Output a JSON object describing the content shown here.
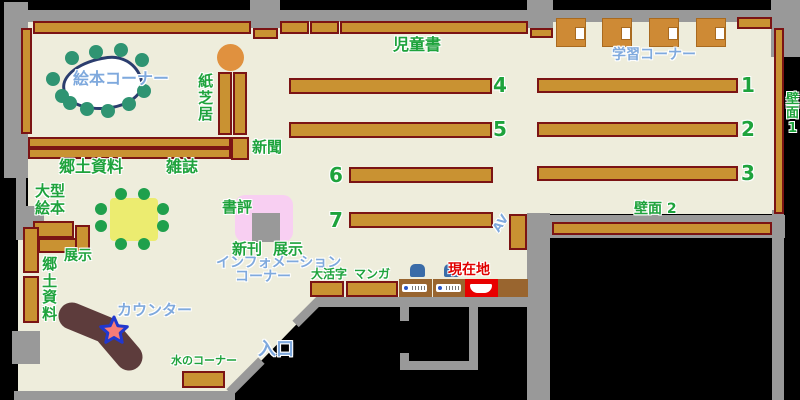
{
  "map": {
    "colors": {
      "floor": "#eeeddc",
      "wall": "#999999",
      "shelf_fill": "#c99232",
      "shelf_border": "#7b1414",
      "label_green": "#1ea33c",
      "label_blue": "#7fa9dd",
      "label_red": "#e00000",
      "counter_brown": "#5d3c3c",
      "current_location_red": "#e80000"
    },
    "labels": {
      "picture_book_corner": "絵本コーナー",
      "kamishibai": "紙芝居",
      "newspaper": "新聞",
      "childrens_books": "児童書",
      "study_corner": "学習コーナー",
      "wall_1": "壁面1",
      "local_materials_top": "郷土資料",
      "magazines": "雑誌",
      "large_picture_books": "大型絵本",
      "display_left": "展示",
      "local_materials_left": "郷土資料",
      "book_reviews": "書評",
      "new_books": "新刊",
      "display_right": "展示",
      "information_line1": "インフォメーション",
      "information_line2": "コーナー",
      "counter": "カウンター",
      "water_corner": "水のコーナー",
      "entrance": "入口",
      "large_print": "大活字",
      "manga": "マンガ",
      "current_location": "現在地",
      "wall_2": "壁面 2",
      "av": "AV"
    },
    "shelf_numbers": {
      "n1": "1",
      "n2": "2",
      "n3": "3",
      "n4": "4",
      "n5": "5",
      "n6": "6",
      "n7": "7"
    }
  }
}
